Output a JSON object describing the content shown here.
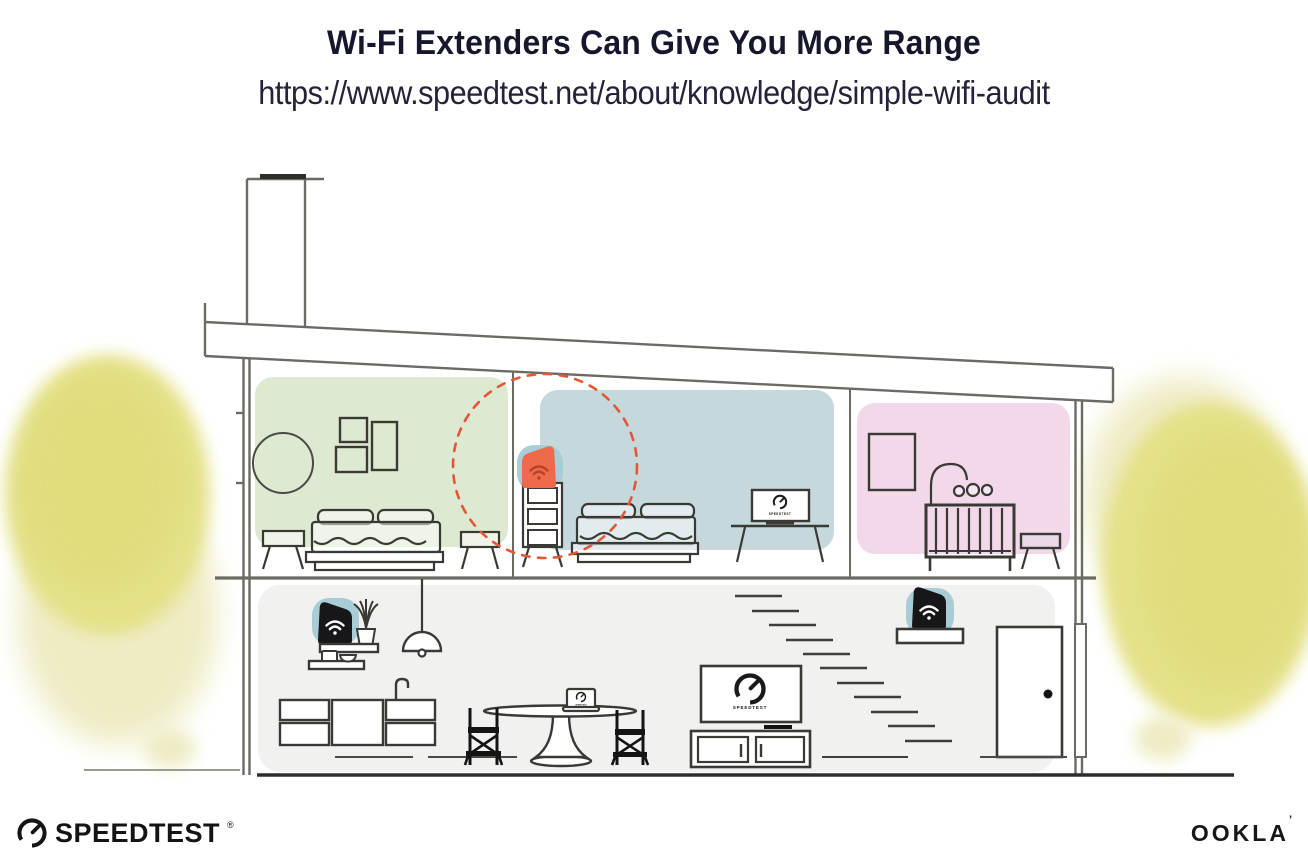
{
  "header": {
    "title": "Wi-Fi Extenders Can Give You More Range",
    "url": "https://www.speedtest.net/about/knowledge/simple-wifi-audit"
  },
  "illustration": {
    "screen_label": "SPEEDTEST",
    "colors": {
      "bedroom_green": "#dde9d1",
      "bedroom_blue": "#c5d9dc",
      "nursery_pink": "#f2d8e9",
      "downstairs_gray": "#f1f1ef",
      "device_pad_teal": "#a9cdd6",
      "extender_orange": "#ee6a4a",
      "extender_wifi_red": "#b5432a",
      "device_black": "#17171a",
      "range_dash_red": "#e15737",
      "foliage_yellow": "#e4e188",
      "structure_line": "#6b6b64",
      "ink": "#2f2f2a"
    }
  },
  "footer": {
    "speedtest_text": "SPEEDTEST",
    "speedtest_reg": "®",
    "ookla_text": "OOKLA",
    "ookla_mark": "’"
  }
}
